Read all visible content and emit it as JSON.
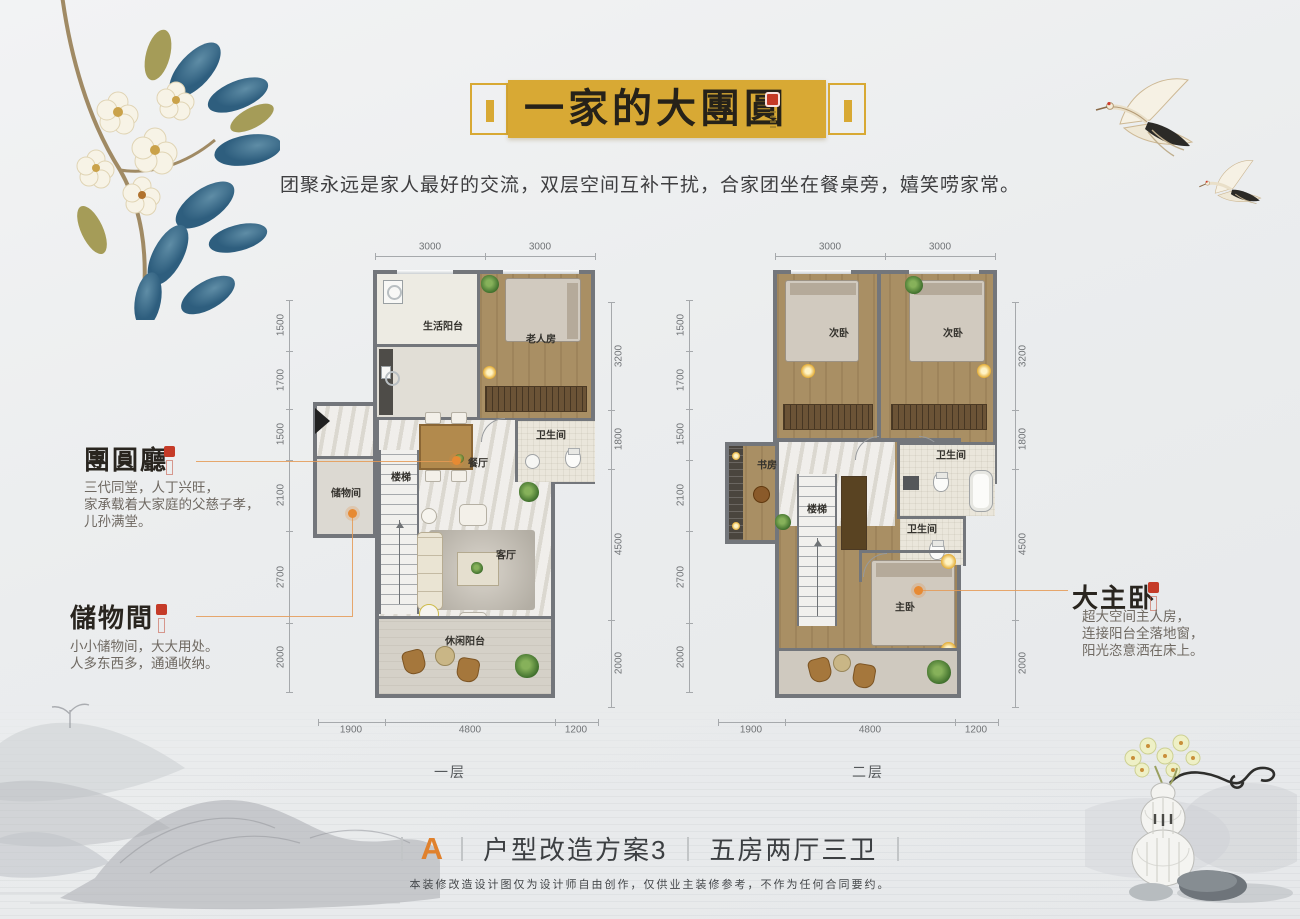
{
  "banner": {
    "title": "一家的大團圓"
  },
  "subtitle": "团聚永远是家人最好的交流，双层空间互补干扰，合家团坐在餐桌旁，嬉笑唠家常。",
  "annotations": {
    "hall": {
      "title": "團圓廳",
      "line1": "三代同堂，人丁兴旺，",
      "line2": "家承载着大家庭的父慈子孝，",
      "line3": "儿孙满堂。"
    },
    "storage": {
      "title": "儲物間",
      "line1": "小小储物间，大大用处。",
      "line2": "人多东西多，通通收纳。"
    },
    "master": {
      "title": "大主卧",
      "line1": "超大空间主人房，",
      "line2": "连接阳台全落地窗，",
      "line3": "阳光恣意洒在床上。"
    }
  },
  "floor1": {
    "label": "一层",
    "rooms": {
      "service_balcony": "生活阳台",
      "elder": "老人房",
      "bath": "卫生间",
      "dining": "餐厅",
      "storage": "储物间",
      "stairs": "楼梯",
      "living": "客厅",
      "leisure": "休闲阳台"
    },
    "dims": {
      "top": [
        "3000",
        "3000"
      ],
      "left": [
        "1500",
        "1700",
        "1500",
        "2100",
        "2700",
        "2000"
      ],
      "right": [
        "3200",
        "1800",
        "4500",
        "2000"
      ],
      "bottom": [
        "1900",
        "4800",
        "1200"
      ]
    }
  },
  "floor2": {
    "label": "二层",
    "rooms": {
      "bed_a": "次卧",
      "bed_b": "次卧",
      "study": "书房",
      "bath_a": "卫生间",
      "bath_b": "卫生间",
      "stairs": "楼梯",
      "master": "主卧"
    },
    "dims": {
      "top": [
        "3000",
        "3000"
      ],
      "left": [
        "1500",
        "1700",
        "1500",
        "2100",
        "2700",
        "2000"
      ],
      "right": [
        "3200",
        "1800",
        "4500",
        "2000"
      ],
      "bottom": [
        "1900",
        "4800",
        "1200"
      ]
    }
  },
  "footer": {
    "letter": "A",
    "name": "户型改造方案3",
    "spec": "五房两厅三卫",
    "disclaimer": "本装修改造设计图仅为设计师自由创作，仅供业主装修参考，不作为任何合同要约。"
  },
  "colors": {
    "banner_gold": "#d8a934",
    "seal_red": "#c43a26",
    "accent_orange": "#e0812d",
    "wall_grey": "#73767b"
  }
}
